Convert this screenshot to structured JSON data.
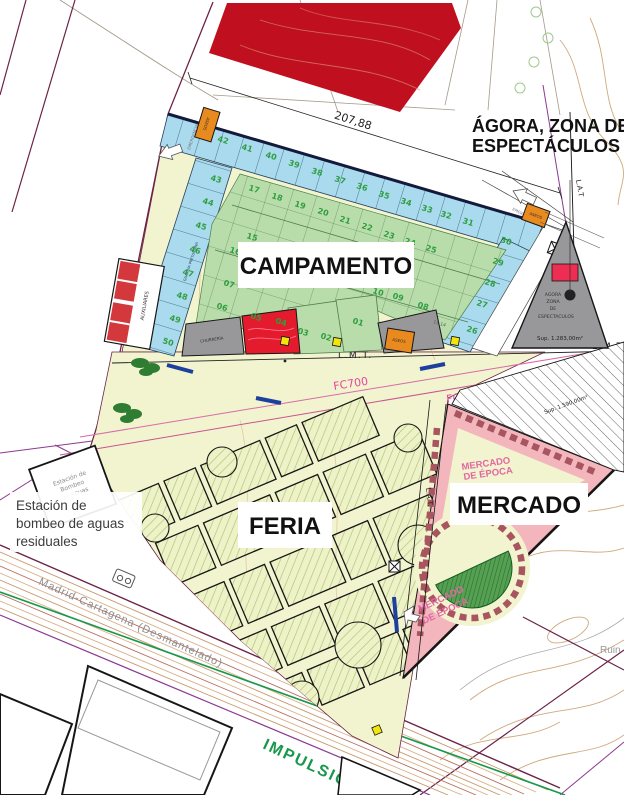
{
  "zone_labels": {
    "campamento": "CAMPAMENTO",
    "feria": "FERIA",
    "mercado": "MERCADO",
    "agora_line1": "ÁGORA, ZONA DE",
    "agora_line2": "ESPECTÁCULOS"
  },
  "annotations": {
    "elevation": "207,88",
    "lmt": "L.M.T.",
    "lmt_right": "L.M.T",
    "lat_top": "L.A.T",
    "lat_mid": "L.A.T.",
    "fc700": "FC700",
    "impulsion": "IMPULSIÓN 50",
    "railway": "Madrid-Cartagena  (Desmantelado)",
    "ruins": "Ruin",
    "dim_1514": "15,14"
  },
  "pump_station": {
    "note_line1": "Estación de",
    "note_line2": "bombeo de aguas",
    "note_line3": "residuales",
    "plot_line1": "Estación de",
    "plot_line2": "Bombeo",
    "plot_line3": "de Aguas"
  },
  "agora_triangle": {
    "line1": "AGORA",
    "line2": "ZONA",
    "line3": "DE",
    "line4": "ESPECTACULOS",
    "area": "Sup. 1.283,00m²"
  },
  "field_area": "Sup. 1.590,00m²",
  "mercado_inner": {
    "line1": "MERCADO",
    "line2": "DE ÉPOCA"
  },
  "small_labels": {
    "aseos": "ASEOS",
    "auxiliares": "AUXILIARES",
    "churreria": "CHURRERÍA",
    "emergencia": "EMERGENCIA",
    "guardia": "GUARDIA PRETORIANA"
  },
  "plots": {
    "blue_numbers": [
      {
        "n": "26",
        "x": 466,
        "y": 331
      },
      {
        "n": "27",
        "x": 476,
        "y": 305
      },
      {
        "n": "28",
        "x": 484,
        "y": 284
      },
      {
        "n": "29",
        "x": 492,
        "y": 263
      },
      {
        "n": "30",
        "x": 500,
        "y": 242
      },
      {
        "n": "31",
        "x": 462,
        "y": 223
      },
      {
        "n": "32",
        "x": 440,
        "y": 216
      },
      {
        "n": "33",
        "x": 421,
        "y": 210
      },
      {
        "n": "34",
        "x": 400,
        "y": 203
      },
      {
        "n": "35",
        "x": 378,
        "y": 196
      },
      {
        "n": "36",
        "x": 356,
        "y": 188
      },
      {
        "n": "37",
        "x": 334,
        "y": 181
      },
      {
        "n": "38",
        "x": 311,
        "y": 173
      },
      {
        "n": "39",
        "x": 288,
        "y": 165
      },
      {
        "n": "40",
        "x": 265,
        "y": 157
      },
      {
        "n": "41",
        "x": 241,
        "y": 149
      },
      {
        "n": "42",
        "x": 217,
        "y": 141
      },
      {
        "n": "43",
        "x": 210,
        "y": 180
      },
      {
        "n": "44",
        "x": 202,
        "y": 203
      },
      {
        "n": "45",
        "x": 195,
        "y": 227
      },
      {
        "n": "46",
        "x": 189,
        "y": 251
      },
      {
        "n": "47",
        "x": 182,
        "y": 274
      },
      {
        "n": "48",
        "x": 176,
        "y": 297
      },
      {
        "n": "49",
        "x": 169,
        "y": 320
      },
      {
        "n": "50",
        "x": 162,
        "y": 343
      }
    ],
    "green_numbers": [
      {
        "n": "01",
        "x": 352,
        "y": 323
      },
      {
        "n": "02",
        "x": 320,
        "y": 338
      },
      {
        "n": "03",
        "x": 297,
        "y": 333
      },
      {
        "n": "04",
        "x": 275,
        "y": 323
      },
      {
        "n": "05",
        "x": 250,
        "y": 318
      },
      {
        "n": "06",
        "x": 216,
        "y": 308
      },
      {
        "n": "07",
        "x": 223,
        "y": 285
      },
      {
        "n": "08",
        "x": 417,
        "y": 307
      },
      {
        "n": "09",
        "x": 392,
        "y": 298
      },
      {
        "n": "10",
        "x": 372,
        "y": 293
      },
      {
        "n": "11",
        "x": 347,
        "y": 285
      },
      {
        "n": "12",
        "x": 322,
        "y": 277
      },
      {
        "n": "13",
        "x": 298,
        "y": 270
      },
      {
        "n": "14",
        "x": 273,
        "y": 262
      },
      {
        "n": "15",
        "x": 246,
        "y": 238
      },
      {
        "n": "16",
        "x": 229,
        "y": 252
      },
      {
        "n": "17",
        "x": 248,
        "y": 190
      },
      {
        "n": "18",
        "x": 271,
        "y": 198
      },
      {
        "n": "19",
        "x": 294,
        "y": 206
      },
      {
        "n": "20",
        "x": 317,
        "y": 213
      },
      {
        "n": "21",
        "x": 339,
        "y": 221
      },
      {
        "n": "22",
        "x": 361,
        "y": 228
      },
      {
        "n": "23",
        "x": 383,
        "y": 236
      },
      {
        "n": "24",
        "x": 404,
        "y": 243
      },
      {
        "n": "25",
        "x": 425,
        "y": 250
      }
    ]
  },
  "colors": {
    "red_zone": "#c01020",
    "blue_plots": "#a9daee",
    "green_plots": "#b9dcab",
    "green_number": "#2f9e3f",
    "cream": "#f2f3cf",
    "pink_mercado": "#f2b6bc",
    "pink_wall": "#a85560",
    "orange": "#e98a1e",
    "gray_zone": "#98989a",
    "yellow": "#f2e50e",
    "magenta": "#e8449c",
    "purple": "#8b3a92",
    "maroon": "#6b2346",
    "contour": "#cfa97e",
    "green_line": "#17984a",
    "navy_edge": "#141a3c",
    "red_stage": "#e41b2c",
    "amph_green": "#2f8f3c"
  }
}
